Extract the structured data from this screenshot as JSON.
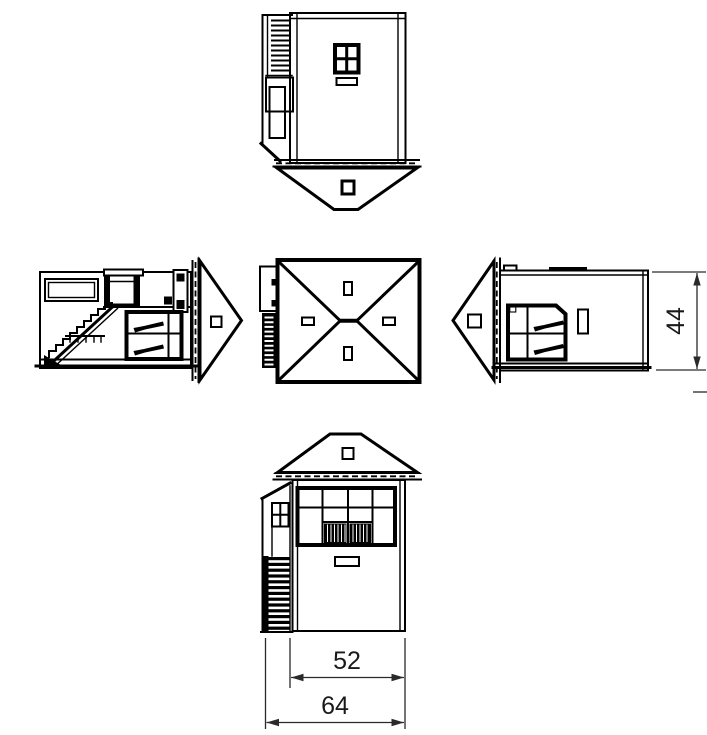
{
  "drawing": {
    "background_color": "#ffffff",
    "line_color": "#000000",
    "dimension_color": "#1a1a1a",
    "dimensions": {
      "height": "44",
      "cabin_width": "52",
      "overall_width": "64"
    }
  }
}
